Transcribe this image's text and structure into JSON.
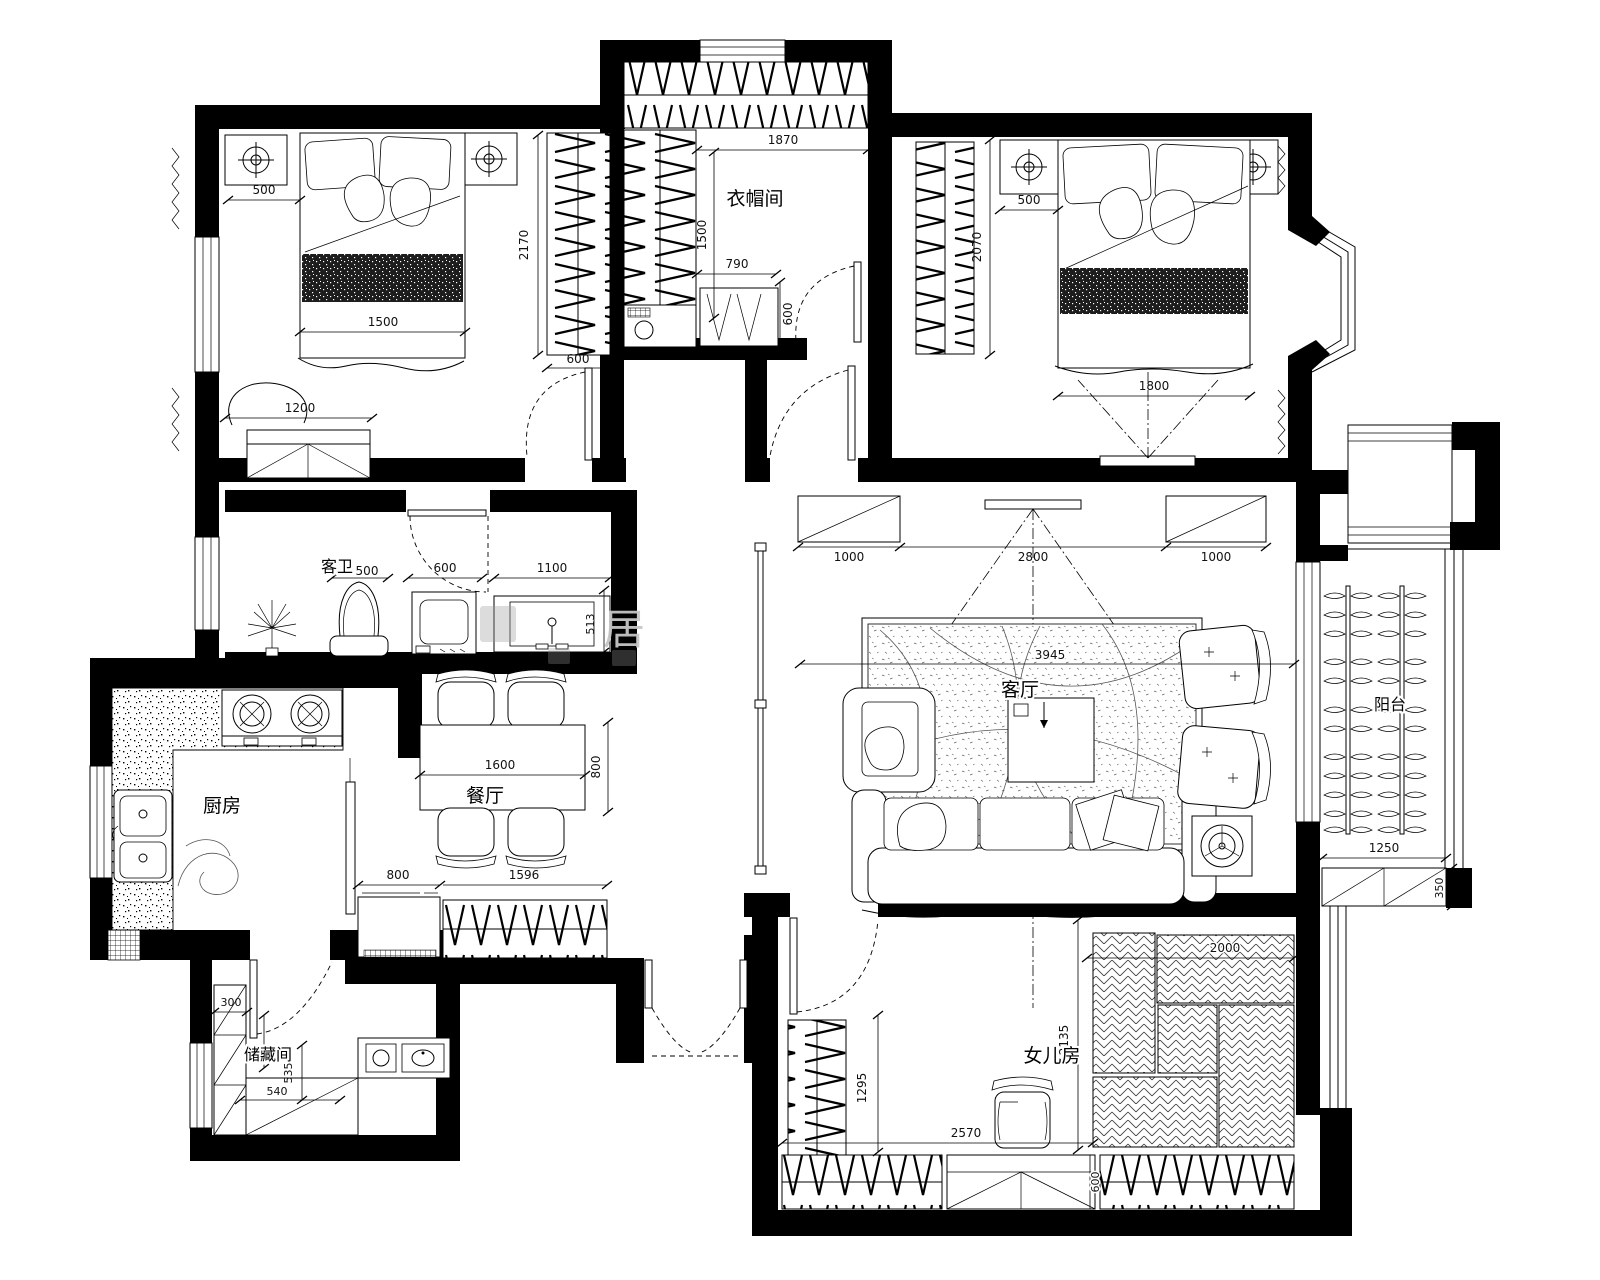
{
  "plan": {
    "watermark": "居",
    "rooms": {
      "closet": "衣帽间",
      "bath": "客卫",
      "kitchen": "厨房",
      "dining": "餐厅",
      "living": "客厅",
      "balcony": "阳台",
      "storage": "储藏间",
      "daughter": "女儿房"
    },
    "dims": {
      "tl_500": "500",
      "tl_1500": "1500",
      "tl_2170": "2170",
      "tl_600": "600",
      "tl_1200": "1200",
      "cl_1870": "1870",
      "cl_1500": "1500",
      "cl_790": "790",
      "cl_600": "600",
      "tr_500": "500",
      "tr_2070": "2070",
      "tr_1800": "1800",
      "ba_500": "500",
      "ba_600": "600",
      "ba_1100": "1100",
      "ba_513": "513",
      "lv_1000l": "1000",
      "lv_2800": "2800",
      "lv_1000r": "1000",
      "lv_3945": "3945",
      "dn_1600": "1600",
      "dn_800": "800",
      "hl_800": "800",
      "hl_1596": "1596",
      "bc_1250": "1250",
      "bc_350": "350",
      "st_300": "300",
      "st_555": "555",
      "st_535": "535",
      "st_540": "540",
      "dt_2000": "2000",
      "dt_2135": "2135",
      "dt_1295": "1295",
      "dt_2570": "2570",
      "dt_600": "600"
    }
  }
}
